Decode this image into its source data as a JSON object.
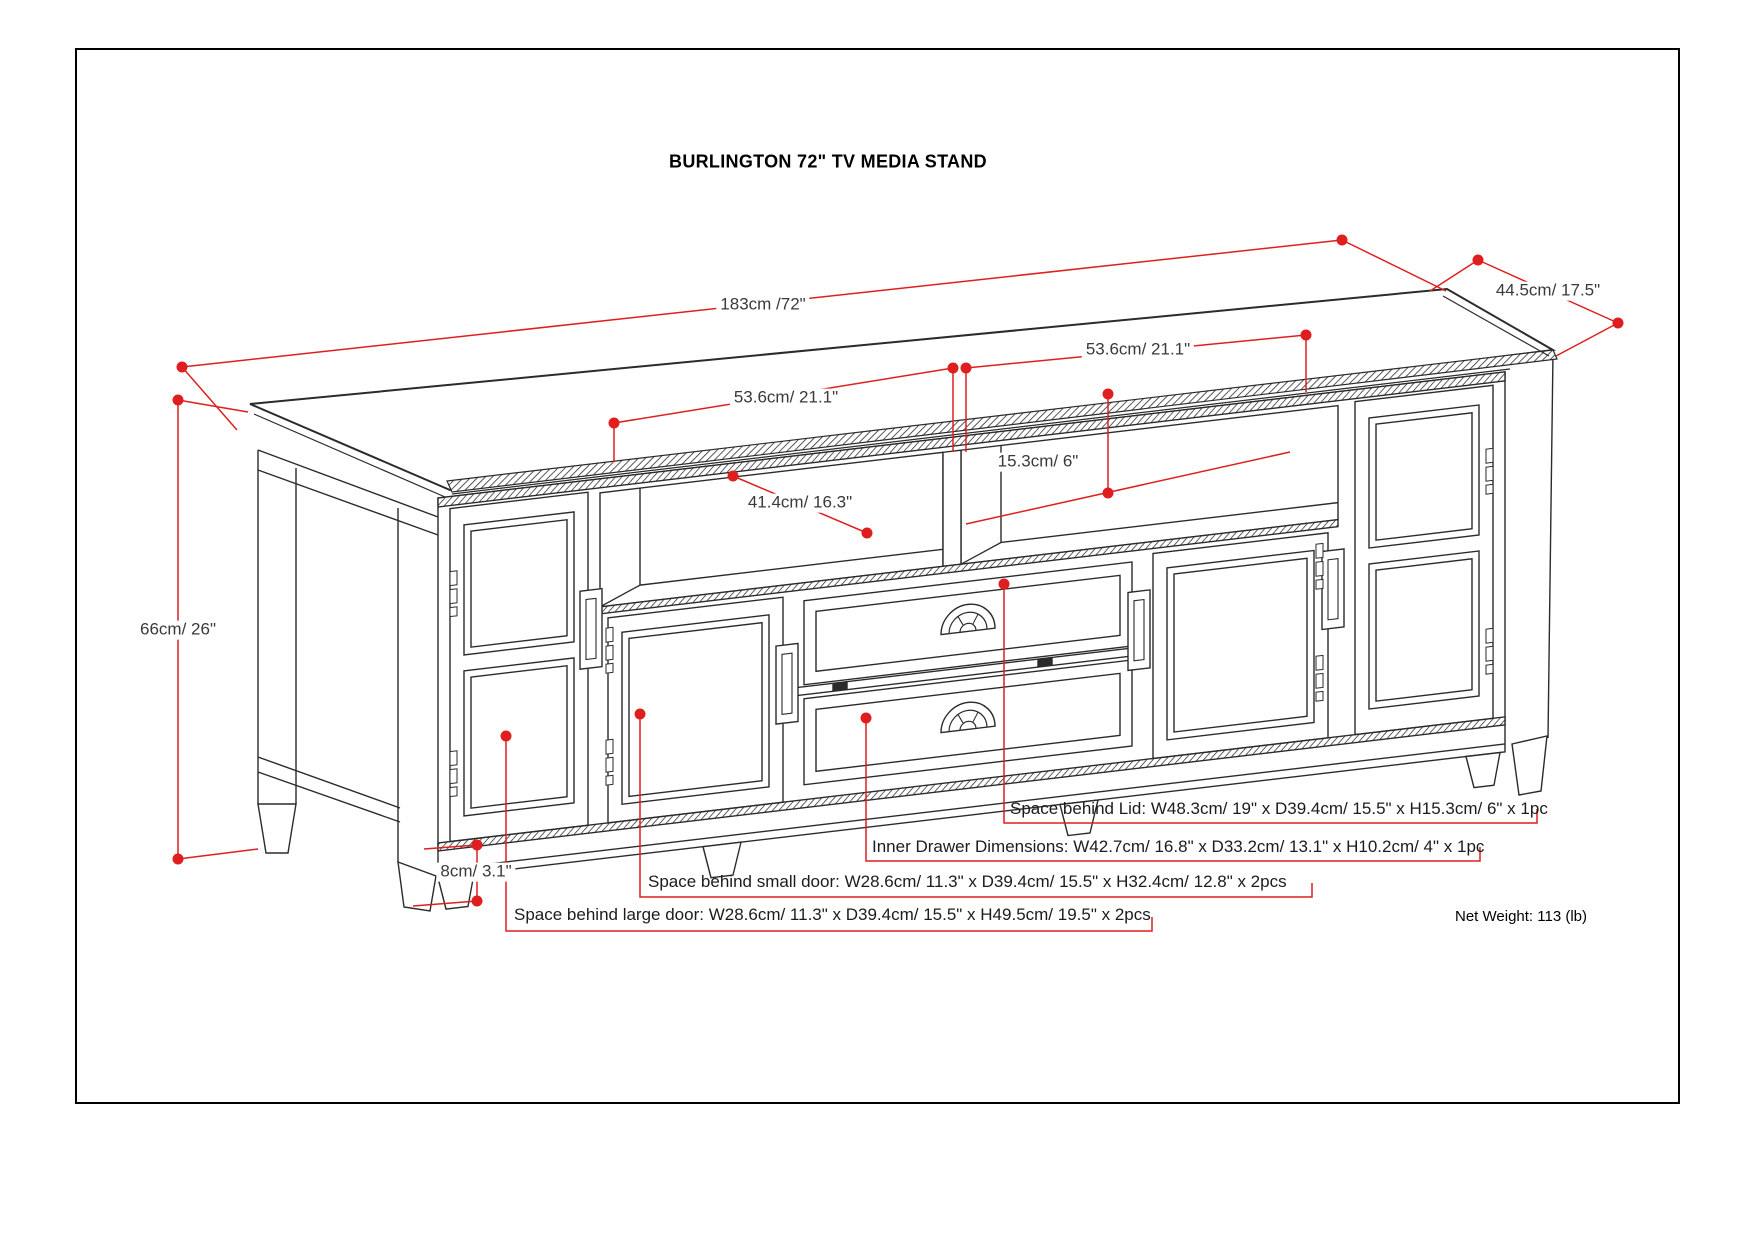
{
  "title": "BURLINGTON 72\" TV MEDIA STAND",
  "dimension_labels": {
    "overall_width": "183cm /72\"",
    "overall_depth": "44.5cm/ 17.5\"",
    "overall_height": "66cm/ 26\"",
    "left_opening_width": "53.6cm/ 21.1\"",
    "right_opening_width": "53.6cm/ 21.1\"",
    "opening_height": "15.3cm/ 6\"",
    "opening_depth": "41.4cm/ 16.3\"",
    "leg_height": "8cm/ 3.1\""
  },
  "callouts": {
    "lid": "Space behind Lid: W48.3cm/ 19\" x D39.4cm/ 15.5\" x H15.3cm/ 6\" x 1pc",
    "inner_drawer": "Inner Drawer Dimensions: W42.7cm/ 16.8\" x D33.2cm/ 13.1\" x H10.2cm/ 4\" x 1pc",
    "small_door": "Space behind small door: W28.6cm/ 11.3\" x D39.4cm/ 15.5\" x H32.4cm/ 12.8\" x 2pcs",
    "large_door": "Space behind large door: W28.6cm/ 11.3\" x D39.4cm/ 15.5\" x H49.5cm/ 19.5\" x 2pcs"
  },
  "net_weight": "Net Weight: 113 (lb)",
  "colors": {
    "annotation_red": "#df1f1f",
    "drawing_black": "#2b2b2b"
  }
}
